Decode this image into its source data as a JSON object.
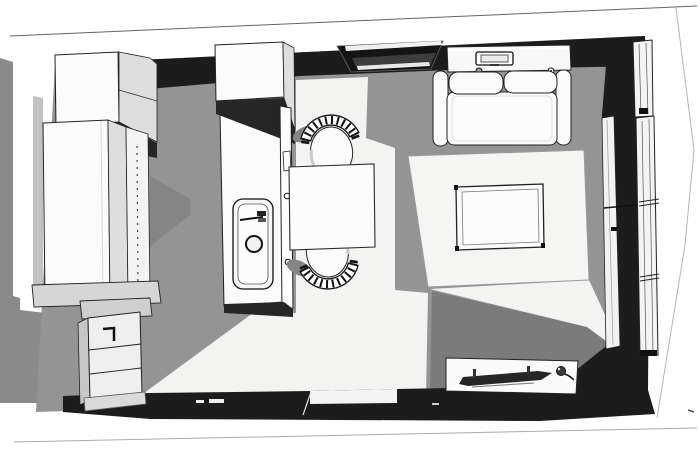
{
  "view": {
    "description": "Monochrome 3D top-down architectural render of a studio apartment floor plan (SketchUp style), no visible text",
    "projection": "bird's-eye perspective",
    "room": "studio apartment with kitchen, dining and living zones"
  },
  "colors": {
    "page": "#ffffff",
    "outside-ground": "#8a8a8a",
    "wall-dark": "#1c1c1c",
    "wall-dark2": "#262626",
    "floor": "#949494",
    "floor-light": "#f3f3f2",
    "floor-shadow": "#7b7b7b",
    "floor-shadow2": "#858585",
    "furniture": "#fbfbfb",
    "furniture-shade": "#dedede",
    "cabinet-side": "#c7c7c7",
    "line": "#222222",
    "line-soft": "#777777",
    "tv-screen": "#262626"
  },
  "scene": {
    "zones": [
      "kitchen",
      "dining",
      "living"
    ],
    "shell": [
      "outer-wall-band",
      "interior-dark-walls",
      "floor",
      "light-patches",
      "wall-niche",
      "window-wall",
      "door-threshold"
    ],
    "kitchen_objects": [
      "wall-cabinet",
      "tall-cabinet",
      "shelf-pin-holes-panel",
      "worktop",
      "drawer-unit",
      "sink-counter",
      "sink-basin",
      "faucet",
      "drain",
      "upper-sink-cabinet"
    ],
    "dining_objects": [
      "square-table",
      "spindle-back-chair-top",
      "spindle-back-chair-bottom"
    ],
    "living_objects": [
      "two-seat-sofa",
      "console-shelf",
      "laptop",
      "area-rug",
      "coffee-table",
      "tv-lowboard",
      "flat-tv",
      "knob-object",
      "tall-window"
    ]
  }
}
